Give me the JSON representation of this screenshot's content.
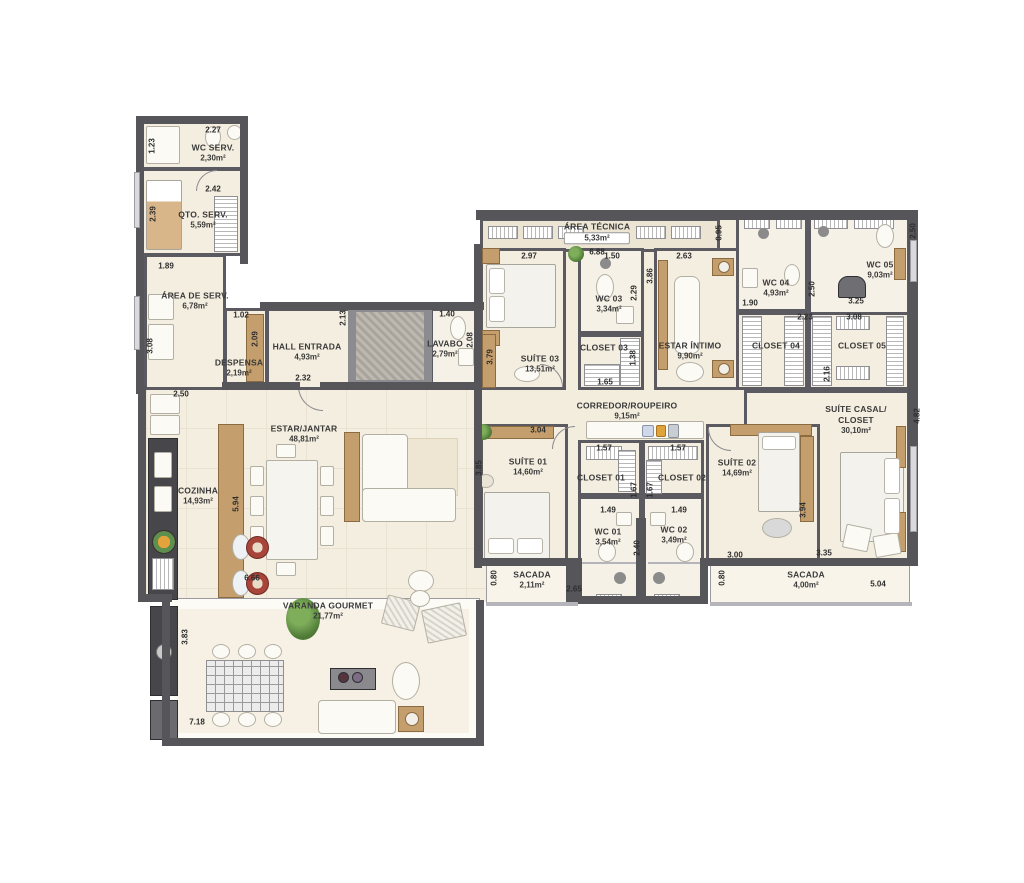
{
  "rooms": {
    "wc_serv": {
      "name": "WC SERV.",
      "area": "2,30m²"
    },
    "qto_serv": {
      "name": "QTO. SERV.",
      "area": "5,59m²"
    },
    "area_serv": {
      "name": "ÁREA DE SERV.",
      "area": "6,78m²"
    },
    "despensa": {
      "name": "DESPENSA",
      "area": "2,19m²"
    },
    "hall": {
      "name": "HALL ENTRADA",
      "area": "4,93m²"
    },
    "lavabo": {
      "name": "LAVABO",
      "area": "2,79m²"
    },
    "area_tecnica": {
      "name": "ÁREA TÉCNICA",
      "area": "5,33m²"
    },
    "suite03": {
      "name": "SUÍTE 03",
      "area": "13,51m²"
    },
    "wc03": {
      "name": "WC 03",
      "area": "3,34m²"
    },
    "closet03": {
      "name": "CLOSET 03",
      "area": ""
    },
    "estar_intimo": {
      "name": "ESTAR ÍNTIMO",
      "area": "9,90m²"
    },
    "wc04": {
      "name": "WC 04",
      "area": "4,93m²"
    },
    "wc05": {
      "name": "WC 05",
      "area": "9,03m²"
    },
    "closet04": {
      "name": "CLOSET 04",
      "area": ""
    },
    "closet05": {
      "name": "CLOSET 05",
      "area": ""
    },
    "corredor": {
      "name": "CORREDOR/ROUPEIRO",
      "area": "9,15m²"
    },
    "suite01": {
      "name": "SUÍTE 01",
      "area": "14,60m²"
    },
    "closet01": {
      "name": "CLOSET 01",
      "area": ""
    },
    "closet02": {
      "name": "CLOSET 02",
      "area": ""
    },
    "wc01": {
      "name": "WC 01",
      "area": "3,54m²"
    },
    "wc02": {
      "name": "WC 02",
      "area": "3,49m²"
    },
    "suite02": {
      "name": "SUÍTE 02",
      "area": "14,69m²"
    },
    "suite_casal": {
      "name": "SUÍTE CASAL/",
      "name2": "CLOSET",
      "area": "30,10m²"
    },
    "sacada1": {
      "name": "SACADA",
      "area": "2,11m²"
    },
    "sacada2": {
      "name": "SACADA",
      "area": "4,00m²"
    },
    "estar_jantar": {
      "name": "ESTAR/JANTAR",
      "area": "48,81m²"
    },
    "cozinha": {
      "name": "COZINHA",
      "area": "14,93m²"
    },
    "varanda": {
      "name": "VARANDA GOURMET",
      "area": "21,77m²"
    }
  },
  "dims": {
    "wcserv_w": "2.27",
    "wcserv_shower": "1.23",
    "qtoserv_w": "2.42",
    "qtoserv_h": "2.39",
    "areaserv_nook": "1.89",
    "areaserv_h": "3.08",
    "despensa_w": "1.02",
    "despensa_h": "2.09",
    "hall_w": "2.32",
    "cozinha_top": "2.50",
    "elev_h": "2.13",
    "lavabo_w": "1.40",
    "lavabo_h": "2.08",
    "suite03_l": "3.79",
    "areatec_w": "6.88",
    "suite03_w": "2.97",
    "wc03_w": "1.50",
    "estarintimo_w": "2.63",
    "estarintimo_n": "0.95",
    "estarintimo_h": "3.86",
    "wc03_h": "2.29",
    "closet03_w": "1.65",
    "closet03_h": "1.38",
    "wc04_w": "1.90",
    "wc04_h": "2.50",
    "wc05_w": "3.25",
    "wc05_h": "2.50",
    "closet04_w": "2.23",
    "closet05_w": "3.08",
    "closet05_h": "2.16",
    "suitecasal_h": "4.82",
    "suite01_w": "3.04",
    "suite01_h": "3.85",
    "closet01_w": "1.57",
    "closet02_w": "1.57",
    "closet01_h": "1.67",
    "closet02_h": "1.67",
    "wc01_w": "1.49",
    "wc02_w": "1.49",
    "wc_h": "2.40",
    "sacada1_d": "0.80",
    "sacada1_w": "2.65",
    "suite02_b": "3.00",
    "suitecasal_b": "3.35",
    "sacada2_d": "0.80",
    "sacada2_w": "5.04",
    "suite02_h": "3.94",
    "cozinha_h": "5.94",
    "cozinha_b": "6.66",
    "varanda_h": "3.83",
    "varanda_w": "7.18"
  },
  "colors": {
    "wall": "#55555a",
    "floor": "#f4eee0",
    "wood": "#c49e6c",
    "balcony": "#f8f4ea"
  }
}
